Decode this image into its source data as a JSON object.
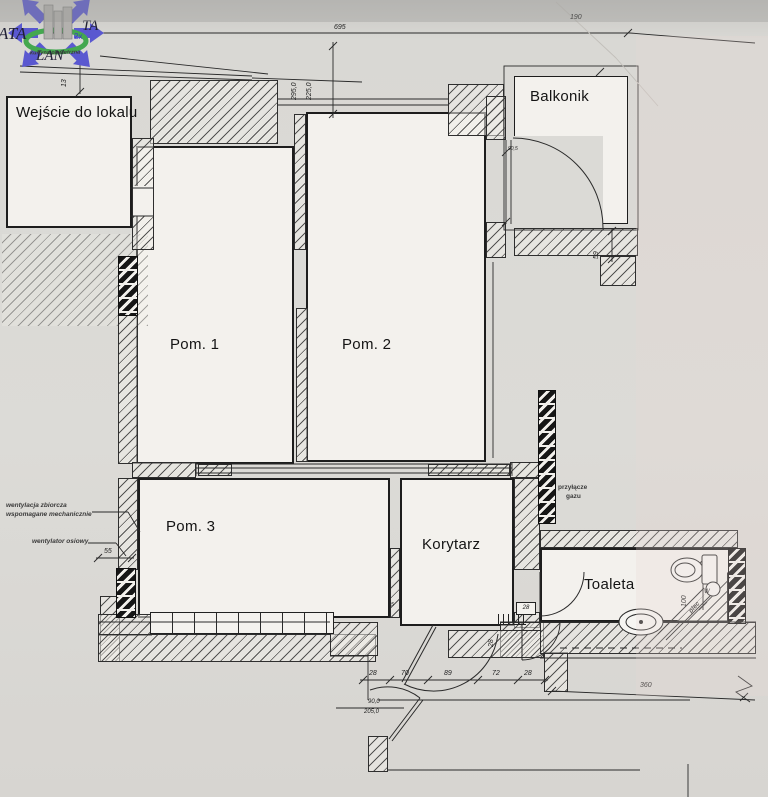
{
  "logo": {
    "ata": "ATA",
    "ta": "TA",
    "lan": "LAN",
    "badge": "2x"
  },
  "rooms": {
    "entrance": "Wejście do lokalu",
    "balcony": "Balkonik",
    "room1": "Pom. 1",
    "room2": "Pom. 2",
    "room3": "Pom. 3",
    "corridor": "Korytarz",
    "toilet": "Toaleta"
  },
  "annotations": {
    "air_curtain": "kurtyna powietrzna",
    "vent_line1": "wentylacja zbiorcza",
    "vent_line2": "wspomagane mechanicznie",
    "fan": "wentylator osiowy",
    "gas1": "przyłącze",
    "gas2": "gazu",
    "stove": "piec",
    "w_mark": "W"
  },
  "dims": {
    "top": "695",
    "top_right": "190",
    "v1": "295,0",
    "v2": "225,0",
    "left_top": "13",
    "right_mid": "59",
    "left_bottom": "55",
    "chain": [
      "28",
      "70",
      "89",
      "72",
      "28"
    ],
    "bottom_right": "360",
    "toilet_depth": "100",
    "toilet_door": "28",
    "pier": "28",
    "partition": "15",
    "balcony_door": "90,5",
    "door_w": "90,0",
    "door_h": "205,0"
  }
}
